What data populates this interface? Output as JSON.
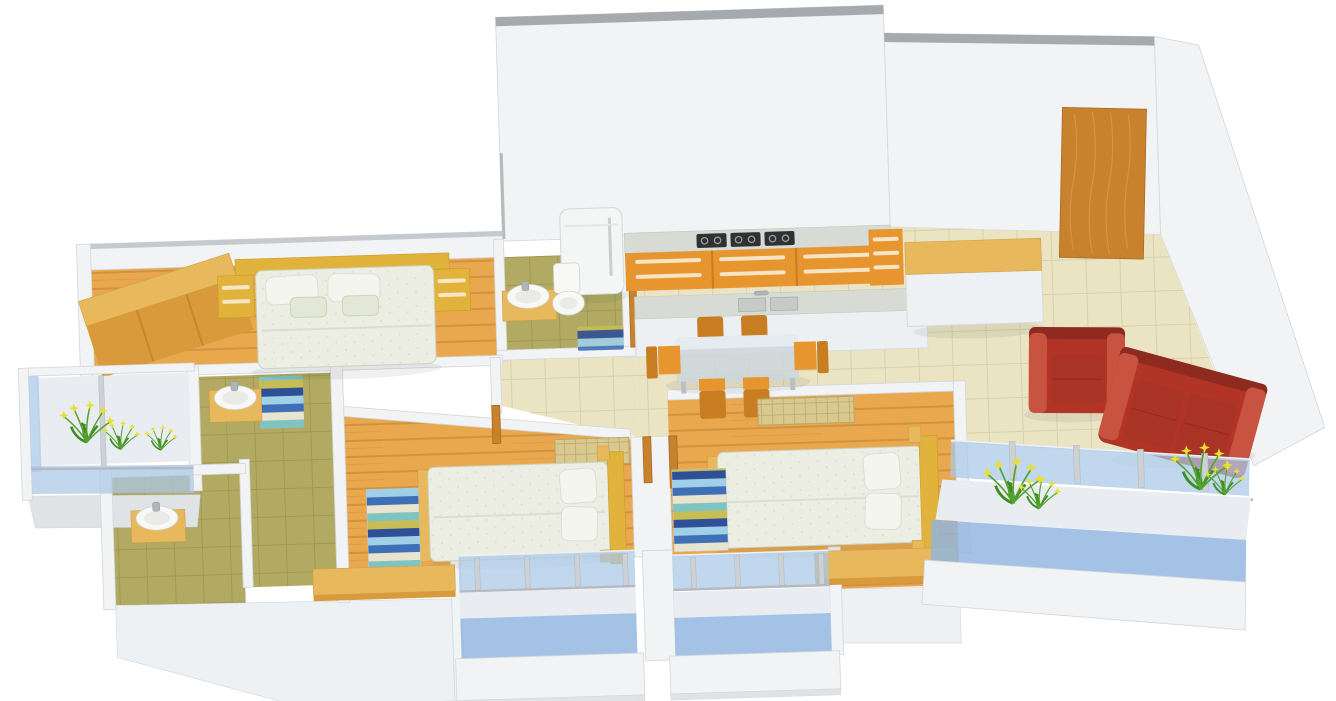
{
  "scene": {
    "kind": "3d-isometric-floor-plan-render",
    "description": "Rendered 3D floor plan of a 3-bedroom apartment; no text labels visible",
    "canvas": {
      "width": 1336,
      "height": 701
    },
    "tilt_deg": -1.8
  },
  "colors": {
    "page_bg": "#ffffff",
    "wall_face": "#f1f3f5",
    "wall_top": "#a6aaae",
    "wall_top_light": "#c6cace",
    "wall_edge": "#d3d7da",
    "base_grey": "#dfe3e6",
    "floor_wood": "#e9a84e",
    "wood_plank_line": "#d2923e",
    "wood_light": "#e8b85c",
    "wood_mid": "#d99a3c",
    "wood_door": "#c8822e",
    "wood_grain": "#dfa050",
    "floor_tile": "#ebe4c3",
    "tile_line": "#d8d0ab",
    "floor_olive": "#b2aa62",
    "olive_line": "#a19952",
    "tatami_tan": "#d9c98f",
    "tatami_line": "#bba968",
    "cabinet_orange": "#e6952f",
    "cabinet_orange_dark": "#c87d22",
    "cabinet_handle": "#f7ead1",
    "counter_marble": "#d8dad4",
    "hob_black": "#2f3133",
    "fridge_white": "#f4f6f6",
    "ceramic_white": "#f8f9f7",
    "bed_linen": "#eceee3",
    "linen_dot": "#dde2cf",
    "headboard_gold": "#e2b33c",
    "pillow_white": "#f3f5ee",
    "sofa_red": "#b23427",
    "sofa_red_dark": "#8e2a1f",
    "sofa_red_light": "#c75340",
    "sofa_cushion": "#a93325",
    "glass_blue": "#a9c7e8",
    "glass_blue_deep": "#8fb4e0",
    "balcony_floor": "#e9edf2",
    "rail_grey": "#b5bac0",
    "glass_table": "#ccd6dd",
    "plant_green": "#55a32f",
    "plant_green_dark": "#3f8c22",
    "flower_yellow": "#e9df2f",
    "rug_sky": "#9fd0e8",
    "rug_blue": "#3f6fb5",
    "rug_cream": "#e8e4d0",
    "rug_teal": "#7fc4c0",
    "rug_sand": "#c7bd55",
    "rug_navy": "#2f4f96"
  },
  "rooms": [
    {
      "id": "master-bedroom",
      "floor": "wood-plank",
      "furniture": [
        "wardrobe-run",
        "double-bed",
        "gold-headboard",
        "nightstand-left",
        "nightstand-right",
        "pillows-x4"
      ]
    },
    {
      "id": "bathroom-attached-master",
      "floor": "olive-tile",
      "furniture": [
        "washbasin-on-wood-counter",
        "toilet",
        "striped-bath-mat"
      ]
    },
    {
      "id": "bathroom-middle",
      "floor": "olive-tile",
      "furniture": [
        "washbasin-on-wood-counter",
        "striped-bath-mat"
      ]
    },
    {
      "id": "bathroom-lower",
      "floor": "olive-tile",
      "furniture": [
        "washbasin-on-wood-counter"
      ]
    },
    {
      "id": "kitchen",
      "floor": "beige-tile",
      "furniture": [
        "refrigerator",
        "marble-countertop",
        "gas-hob-3-sections",
        "orange-base-cabinets",
        "corner-drawer-unit",
        "island-counter",
        "double-bowl-sink"
      ]
    },
    {
      "id": "dining",
      "floor": "beige-tile",
      "furniture": [
        "glass-dining-table",
        "wooden-chairs-x6"
      ]
    },
    {
      "id": "foyer",
      "floor": "beige-tile",
      "furniture": [
        "entrance-wood-door",
        "console-cabinet-wood-top"
      ]
    },
    {
      "id": "living-room",
      "floor": "beige-tile",
      "furniture": [
        "red-leather-armchair",
        "red-leather-sofa-3-seat"
      ]
    },
    {
      "id": "bedroom-2",
      "floor": "wood-plank",
      "furniture": [
        "double-bed",
        "gold-headboard",
        "pillows-x2",
        "striped-rug",
        "wood-desk",
        "tatami-chest"
      ]
    },
    {
      "id": "bedroom-3",
      "floor": "wood-plank",
      "furniture": [
        "double-bed",
        "gold-headboard",
        "pillows-x2",
        "striped-rug",
        "wood-desk",
        "tatami-chest"
      ]
    },
    {
      "id": "balcony-master",
      "railing": "blue-glass",
      "furniture": [
        "flower-plants"
      ]
    },
    {
      "id": "balcony-living",
      "railing": "blue-glass",
      "furniture": [
        "flower-plants-x2"
      ]
    },
    {
      "id": "balcony-bedroom-2",
      "railing": "blue-glass",
      "furniture": []
    },
    {
      "id": "balcony-bedroom-3",
      "railing": "blue-glass",
      "furniture": []
    }
  ]
}
